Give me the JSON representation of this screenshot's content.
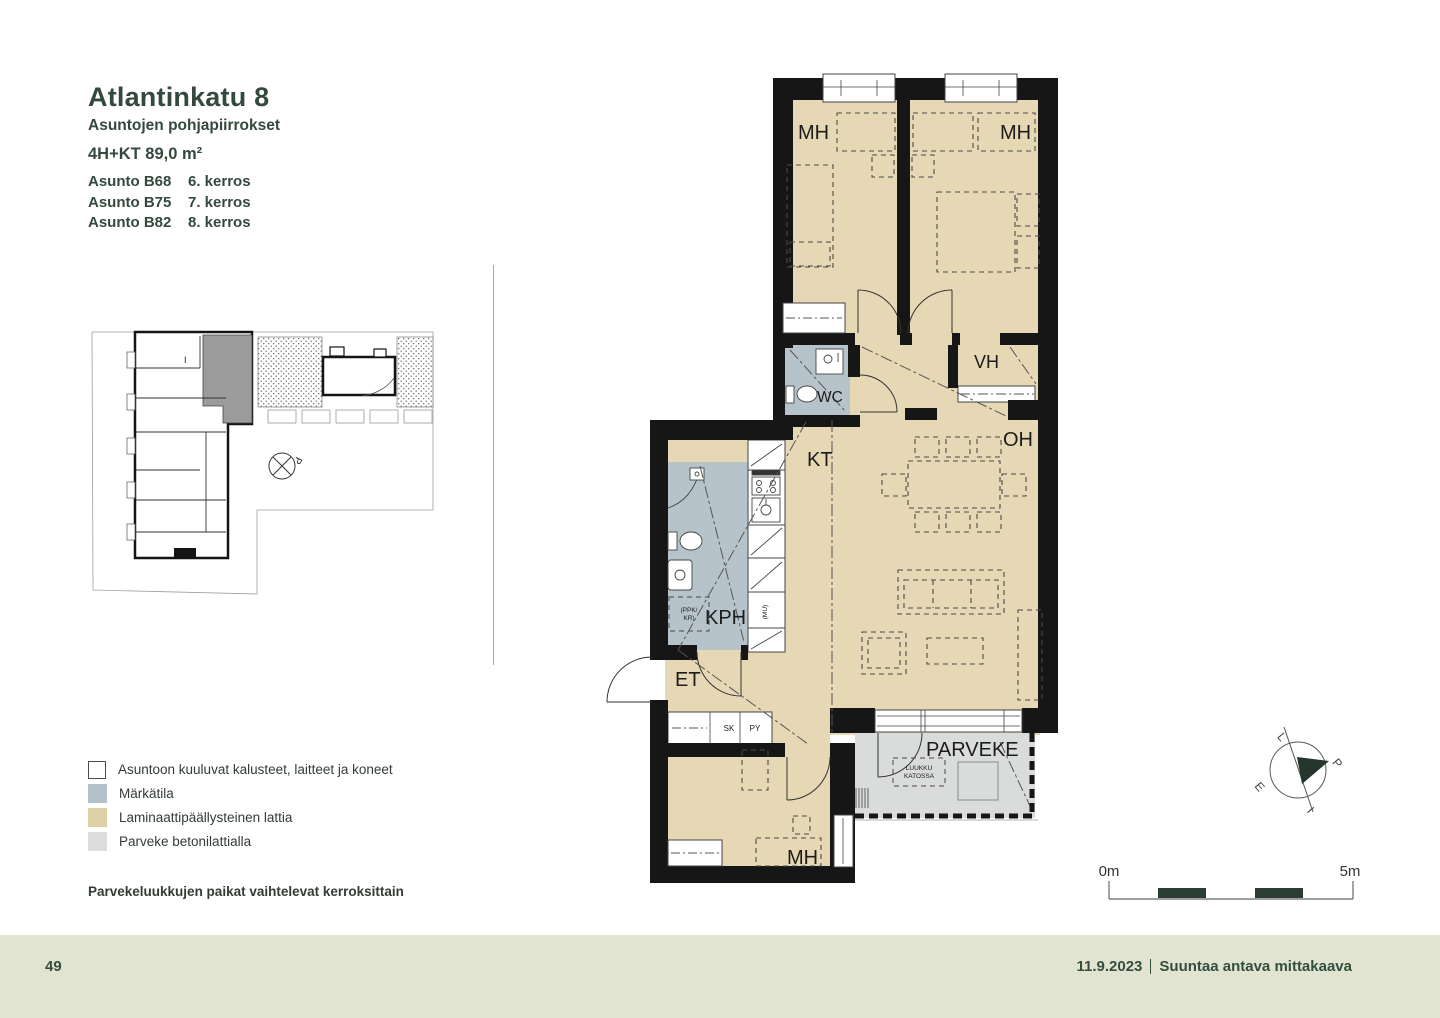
{
  "header": {
    "title": "Atlantinkatu 8",
    "subtitle": "Asuntojen pohjapiirrokset",
    "apartment_type": "4H+KT 89,0 m²",
    "units": [
      {
        "name": "Asunto B68",
        "floor": "6. kerros"
      },
      {
        "name": "Asunto B75",
        "floor": "7. kerros"
      },
      {
        "name": "Asunto B82",
        "floor": "8. kerros"
      }
    ]
  },
  "site_plan": {
    "north_mark": "P",
    "unit_mark": "I"
  },
  "floor_plan": {
    "labels": {
      "bedroom_left": "MH",
      "bedroom_right": "MH",
      "walk_in_closet": "VH",
      "toilet": "WC",
      "living_room": "OH",
      "kitchen": "KT",
      "bathroom": "KPH",
      "entry": "ET",
      "closet_sk": "SK",
      "closet_py": "PY",
      "bedroom_bottom": "MH",
      "balcony": "PARVEKE",
      "hatch_line1": "LUUKKU",
      "hatch_line2": "KATOSSA",
      "washer_line1": "(PPK/",
      "washer_line2": "KR)",
      "microwave": "(MU)"
    }
  },
  "legend": {
    "items": [
      {
        "label": "Asuntoon kuuluvat kalusteet, laitteet ja koneet",
        "color": "#ffffff"
      },
      {
        "label": "Märkätila",
        "color": "#b4c1c8"
      },
      {
        "label": "Laminaattipäällysteinen lattia",
        "color": "#ddd0a4"
      },
      {
        "label": "Parveke betonilattialla",
        "color": "#dcdddd"
      }
    ],
    "note": "Parvekeluukkujen paikat vaihtelevat kerroksittain"
  },
  "scale_bar": {
    "start_label": "0m",
    "end_label": "5m"
  },
  "compass": {
    "west": "L",
    "north": "P",
    "south": "E",
    "east": "I"
  },
  "footer": {
    "page_number": "49",
    "date": "11.9.2023",
    "note": "Suuntaa antava mittakaava"
  },
  "colors": {
    "heading_text": "#33493d",
    "footer_band": "#e0e4d1",
    "floor_laminate": "#e6d8b4",
    "wet_room": "#b7c3ca",
    "balcony_floor": "#dadbdb",
    "wall": "#161616"
  }
}
